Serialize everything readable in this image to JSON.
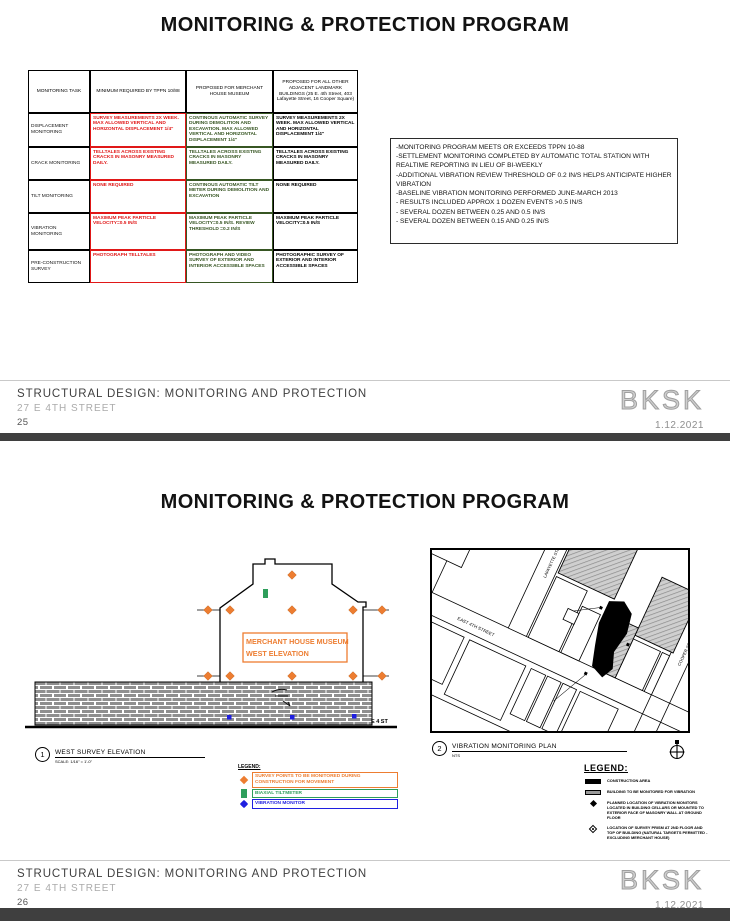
{
  "slide1": {
    "title": "MONITORING &  PROTECTION PROGRAM",
    "table": {
      "headers": [
        "MONITORING TASK",
        "MINIMUM REQUIRED BY TPPN 10/88",
        "PROPOSED FOR MERCHANT HOUSE MUSEUM",
        "PROPOSED FOR ALL OTHER ADJACENT LANDMARK BUILDINGS (25 E. 4th Street, 403 Lafayette Street, 16 Cooper Square)"
      ],
      "rows": [
        {
          "task": "DISPLACEMENT MONITORING",
          "minimum": "SURVEY MEASUREMENTS 2X WEEK. MAX ALLOWED VERTICAL AND HORIZONTAL DISPLACEMENT 1/4\"",
          "museum": "CONTINOUS AUTOMATIC SURVEY DURING DEMOLITION AND EXCAVATION. MAX ALLOWED VERTICAL AND HORIZONTAL DISPLACEMENT 1/4\"",
          "other": "SURVEY MEASUREMENTS 2X WEEK. MAX ALLOWED VERTICAL AND HORIZONTAL DISPLACEMENT 1/4\""
        },
        {
          "task": "CRACK MONITORING",
          "minimum": "TELLTALES ACROSS EXISTING CRACKS IN MASONRY MEASURED DAILY.",
          "museum": "TELLTALES ACROSS EXISTING CRACKS IN MASONRY MEASURED DAILY.",
          "other": "TELLTALES ACROSS EXISTING CRACKS IN MASONRY MEASURED DAILY."
        },
        {
          "task": "TILT MONITORING",
          "minimum": "NONE REQUIRED",
          "museum": "CONTINOUS AUTOMATIC TILT METER DURING DEMOLITION AND EXCAVATION",
          "other": "NONE REQUIRED"
        },
        {
          "task": "VIBRATION MONITORING",
          "minimum": "MAXIMUM PEAK PARTICLE VELOCITY=0.5 IN/S",
          "museum": "MAXIMUM PEAK PARTICLE VELOCITY=0.5 IN/S. REVIEW THRESHOLD =0.2 IN/S",
          "other": "MAXIMUM PEAK PARTICLE VELOCITY=0.5 IN/S"
        },
        {
          "task": "PRE-CONSTRUCTION SURVEY",
          "minimum": "PHOTOGRAPH TELLTALES",
          "museum": "PHOTOGRAPH AND VIDEO SURVEY OF EXTERIOR AND INTERIOR ACCESSIBLE SPACES",
          "other": "PHOTOGRAPHIC SURVEY OF EXTERIOR AND INTERIOR ACCESSIBLE SPACES"
        }
      ]
    },
    "notes": [
      "-MONITORING PROGRAM MEETS OR EXCEEDS TPPN 10-88",
      "-SETTLEMENT MONITORING COMPLETED BY AUTOMATIC TOTAL STATION WITH REALTIME REPORTING IN LIEU OF BI-WEEKLY",
      "-ADDITIONAL VIBRATION REVIEW THRESHOLD OF 0.2 IN/S HELPS ANTICIPATE HIGHER VIBRATION",
      "-BASELINE VIBRATION MONITORING PERFORMED JUNE-MARCH 2013",
      "- RESULTS INCLUDED APPROX 1 DOZEN EVENTS >0.5 IN/S",
      "- SEVERAL DOZEN BETWEEN 0.25 AND 0.5 IN/S",
      "- SEVERAL DOZEN BETWEEN 0.15 AND 0.25 IN/S"
    ],
    "footer": {
      "line1": "STRUCTURAL DESIGN: MONITORING AND PROTECTION",
      "line2": "27 E 4TH STREET",
      "page": "25",
      "logo": "BKSK",
      "date": "1.12.2021"
    }
  },
  "slide2": {
    "title": "MONITORING &  PROTECTION PROGRAM",
    "elevation": {
      "label_line1": "MERCHANT HOUSE MUSEUM",
      "label_line2": "WEST ELEVATION",
      "street_label": "E 4 ST",
      "callout_number": "1",
      "callout_title": "WEST SURVEY ELEVATION",
      "callout_scale": "SCALE: 1/16\" = 1'-0\"",
      "legend_title": "LEGEND:",
      "legend_items": [
        {
          "label": "SURVEY POINTS TO BE MONITORED DURING CONSTRUCTION FOR MOVEMENT",
          "color": "#ED7D31"
        },
        {
          "label": "BIAXIAL TILTMETER",
          "color": "#2E9E5B"
        },
        {
          "label": "VIBRATION MONITOR",
          "color": "#1F1FE0"
        }
      ]
    },
    "plan": {
      "callout_number": "2",
      "callout_title": "VIBRATION MONITORING PLAN",
      "callout_scale": "NTS",
      "street_lafayette": "LAFAYETTE STREET",
      "street_e4th": "EAST 4TH STREET",
      "street_cooper": "COOPER SQUARE",
      "legend_title": "LEGEND:",
      "legend_items": [
        "CONSTRUCTION AREA",
        "BUILDING TO BE MONITORED FOR VIBRATION",
        "PLANNED LOCATION OF VIBRATION MONITORS LOCATED IN BUILDING CELLARS OR MOUNTED TO EXTERIOR FACE OF MASONRY WALL AT GROUND FLOOR",
        "LOCATION OF SURVEY PRISM AT 2ND FLOOR AND TOP OF BUILDING (NATURAL TARGETS PERMITTED - EXCLUDING MERCHANT HOUSE)"
      ]
    },
    "footer": {
      "line1": "STRUCTURAL DESIGN: MONITORING AND PROTECTION",
      "line2": "27 E 4TH STREET",
      "page": "26",
      "logo": "BKSK",
      "date": "1.12.2021"
    }
  },
  "colors": {
    "red": "#E01818",
    "green": "#375623",
    "orange": "#ED7D31",
    "blue": "#1F1FE0"
  }
}
